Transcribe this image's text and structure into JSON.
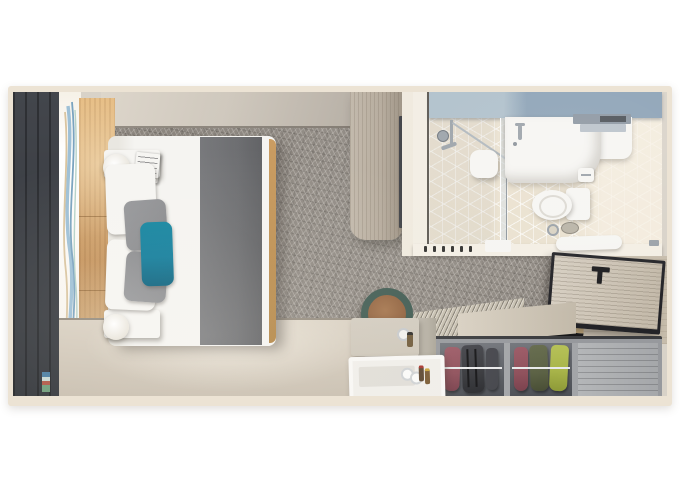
{
  "scene": {
    "label": "Top-down 3D floor plan rendering of a cruise stateroom",
    "view": "top-down render",
    "width_px": 680,
    "height_px": 491,
    "areas": [
      {
        "name": "bedroom",
        "contents": [
          "balcony curtain panel",
          "wavy art curtain",
          "upholstered headboard",
          "double bed with white duvet",
          "gray foot runner",
          "white pillows",
          "gray pillows",
          "teal accent pillow",
          "two nightstands with round lamps",
          "geometric gray carpet"
        ]
      },
      {
        "name": "wardrobe-column",
        "contents": [
          "wood cabinet",
          "wall-mounted tv edge"
        ]
      },
      {
        "name": "bathroom",
        "contents": [
          "blue-gray counter band",
          "shower with glass panel and seat",
          "white vanity sink with faucet",
          "towel shelf",
          "toilet with tank",
          "toilet-paper holder",
          "cube-pattern tile floor",
          "wall hooks",
          "folded towel"
        ]
      },
      {
        "name": "entry",
        "contents": [
          "open cabin door with black T-handle",
          "wood threshold bench"
        ]
      },
      {
        "name": "closet-desk",
        "contents": [
          "open closet with hanging clothes on chrome rails",
          "closed slatted compartment",
          "ribbed closet top",
          "desk with glassware",
          "white tray table with bottles",
          "round stool with leather seat"
        ]
      }
    ]
  },
  "palette": {
    "page_bg": "#ffffff",
    "wall": "#ece3d4",
    "panel_dark": "#43464c",
    "panel_dark2": "#32353a",
    "curtain_blue": "#8fb4cc",
    "curtain_tan": "#d8c3a2",
    "wood_warm": "#c08b52",
    "wood_warm_light": "#e2b477",
    "wood_warm_dark": "#a5743d",
    "carpet": "#8e8881",
    "bed_white": "#f5f4f1",
    "runner_gray": "#6b6c6f",
    "pillow_gray": "#8c8d90",
    "pillow_teal": "#0e7b9a",
    "cabinet_wood": "#b3a899",
    "cabinet_wood_dark": "#9a8f80",
    "tv_dark": "#2b2d31",
    "bath_floor": "#eae1cf",
    "bath_band_left": "#aebfca",
    "bath_band_right": "#8ba1b5",
    "fixture_white": "#f6f5f2",
    "chrome": "#9aa1a8",
    "corridor": "#d5ccbd",
    "door_wood": "#c3b9a9",
    "door_edge": "#232327",
    "closet_top": "#c7c0b1",
    "closet_int": "#5f6268",
    "closet_divider": "#a3a5a8",
    "closet_panel": "#a5a7aa",
    "garment_maroon": "#8e4f5a",
    "garment_dark": "#36373b",
    "garment_olive": "#5b6144",
    "garment_lime": "#a9b54a",
    "desk": "#cdc6b9",
    "tray": "#f0eeea",
    "stool_ring": "#3f5a51",
    "stool_seat": "#8e5f3c",
    "floor_beige": "#d9d0c2",
    "floor_beige_dark": "#c7bdae"
  }
}
